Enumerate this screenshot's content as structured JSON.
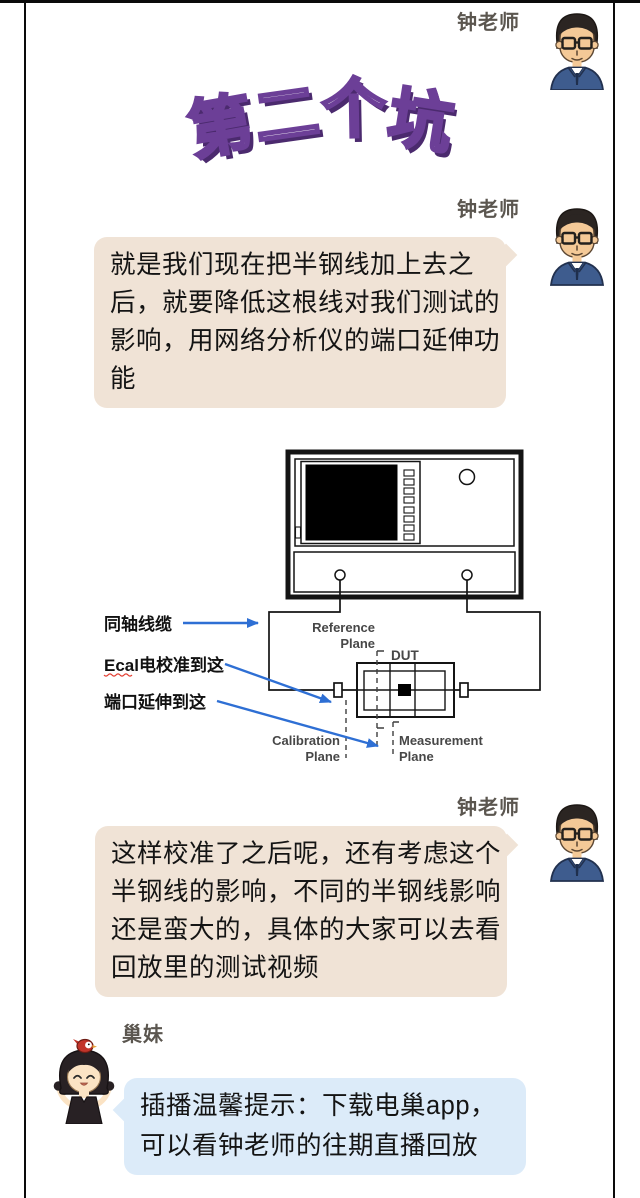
{
  "header": {
    "speaker": "钟老师"
  },
  "title": {
    "text": "第二个坑",
    "chars": [
      "第",
      "二",
      "个",
      "坑"
    ]
  },
  "messages": {
    "m1": {
      "speaker": "钟老师",
      "lines": [
        "就是我们现在把半钢线加上去之",
        "后，就要降低这根线对我们测试的",
        "影响，用网络分析仪的端口延伸功",
        "能"
      ]
    },
    "m2": {
      "speaker": "钟老师",
      "lines": [
        "这样校准了之后呢，还有考虑这个",
        "半钢线的影响，不同的半钢线影响",
        "还是蛮大的，具体的大家可以去看",
        "回放里的测试视频"
      ]
    },
    "m3": {
      "speaker": "巢妹",
      "lines": [
        "插播温馨提示：下载电巢app，",
        "可以看钟老师的往期直播回放"
      ]
    }
  },
  "diagram": {
    "labels": {
      "coax": "同轴线缆",
      "ecal": "Ecal电校准到这",
      "port_extension": "端口延伸到这",
      "reference1": "Reference",
      "reference2": "Plane",
      "dut": "DUT",
      "calibration1": "Calibration",
      "calibration2": "Plane",
      "measurement1": "Measurement",
      "measurement2": "Plane"
    }
  },
  "colors": {
    "teacher_bubble": "#f0e3d6",
    "assistant_bubble": "#dcebf9",
    "title_fill": "#ffffff",
    "title_outline": "#6c3f97",
    "title_shadow": "#4b2a6e",
    "arrow_blue": "#2e6fd4",
    "frame_border": "#0a0a0a",
    "name_gray": "#5b564f"
  },
  "icons": {
    "teacher_avatar": "man-with-glasses-avatar",
    "assistant_avatar": "girl-with-bird-avatar"
  }
}
